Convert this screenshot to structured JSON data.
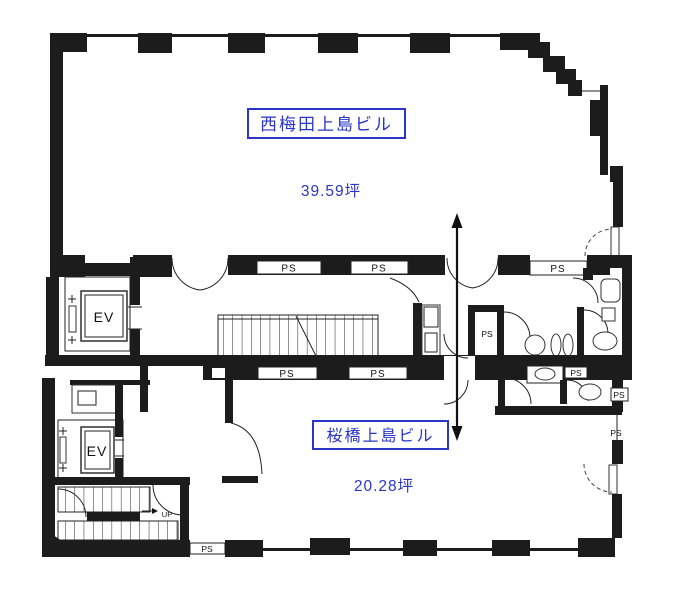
{
  "buildings": {
    "upper": {
      "name": "西梅田上島ビル",
      "area": "39.59坪"
    },
    "lower": {
      "name": "桜橋上島ビル",
      "area": "20.28坪"
    }
  },
  "labels": {
    "elevator": "EV",
    "pipe_space": "PS",
    "stairs_up": "UP"
  },
  "colors": {
    "ink": "#1c1c1c",
    "accent_blue": "#2a35c9",
    "background": "#ffffff"
  }
}
